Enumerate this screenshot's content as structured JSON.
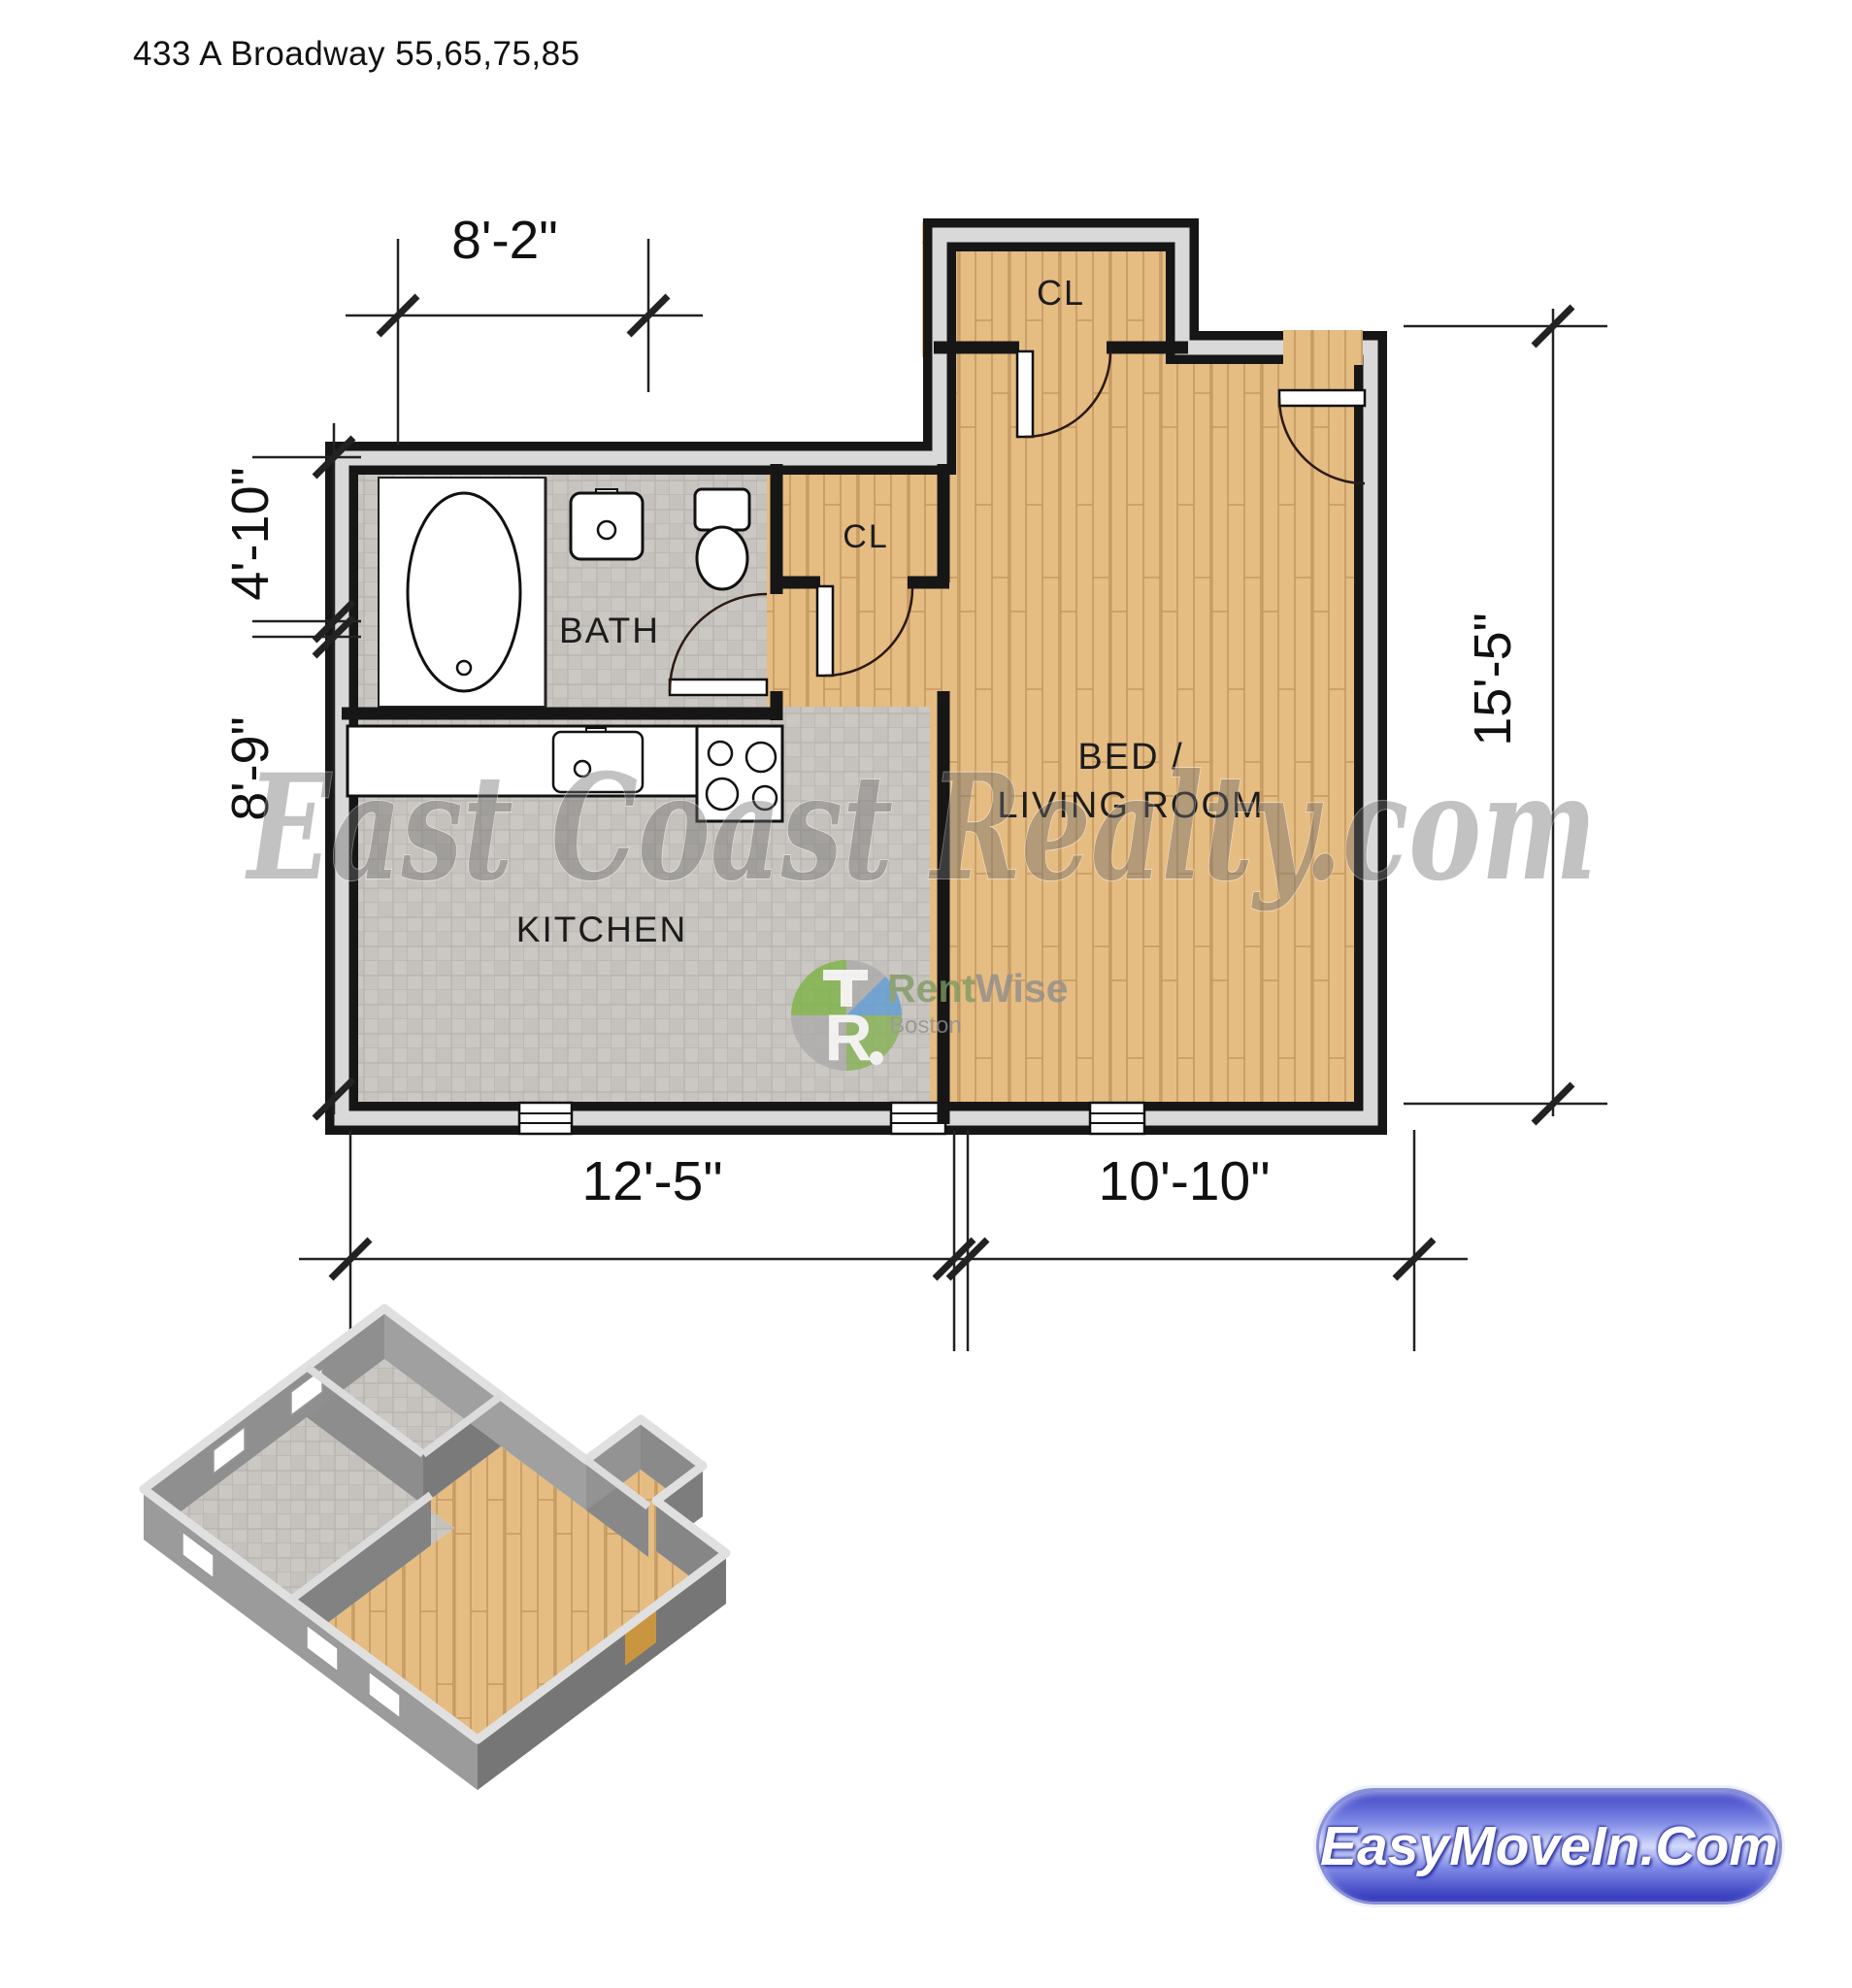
{
  "page": {
    "title": "433 A Broadway 55,65,75,85"
  },
  "floor_plan": {
    "rooms": {
      "bath": "BATH",
      "kitchen": "KITCHEN",
      "bed_living_line1": "BED /",
      "bed_living_line2": "LIVING ROOM",
      "closet_top": "CL",
      "closet_middle": "CL"
    },
    "dimensions": {
      "top": "8'-2\"",
      "left_upper": "4'-10\"",
      "left_lower": "8'-9\"",
      "right": "15'-5\"",
      "bottom_left": "12'-5\"",
      "bottom_right": "10'-10\""
    }
  },
  "watermark": {
    "text": "East Coast Realty.com"
  },
  "rentwise": {
    "name_prefix": "Rent",
    "name_suffix": "Wise",
    "city": "Boston"
  },
  "footer": {
    "button_label": "EasyMoveIn.Com"
  },
  "colors": {
    "wood_floor": "#e5bc82",
    "wood_line": "#c59a62",
    "tile_floor": "#cbc7c2",
    "tile_line": "#b6b2ad",
    "wall": "#161616",
    "wall_cavity": "#d9d9d9",
    "logo_green": "#7cb342",
    "logo_blue": "#5b9bd5",
    "logo_gray": "#ababab",
    "button_blue": "#3d42c4",
    "watermark_gray": "#6f6f6f"
  }
}
